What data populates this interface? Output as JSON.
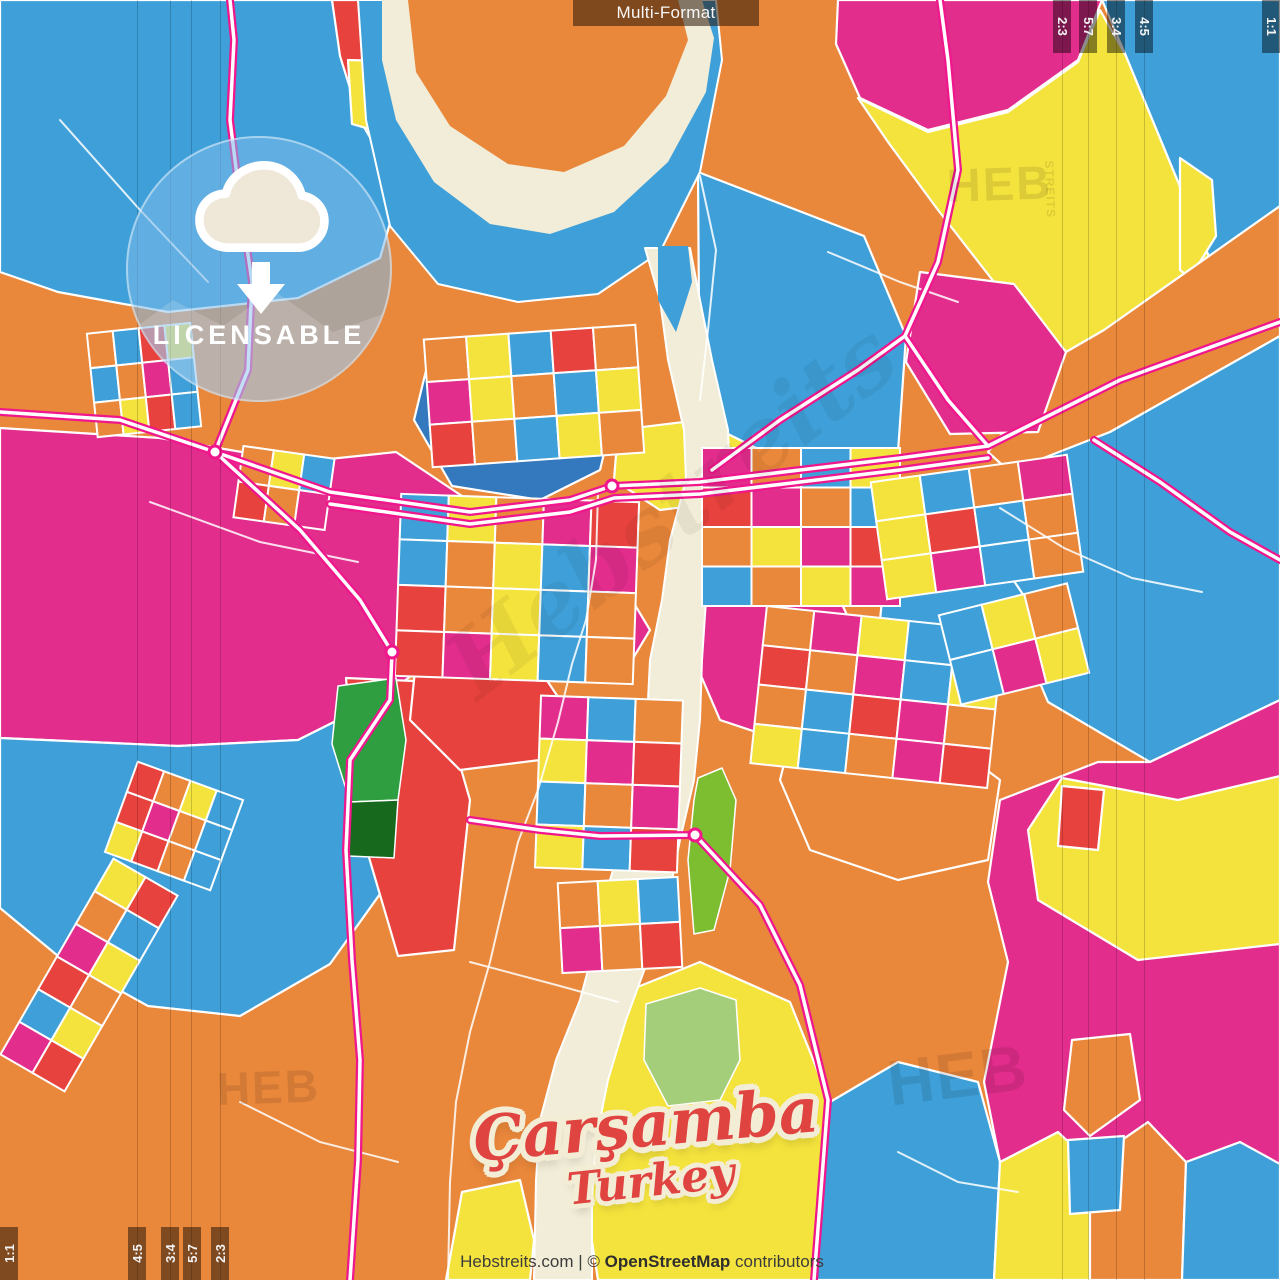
{
  "overlay": {
    "format_label": "Multi-Format",
    "badge": {
      "label": "LICENSABLE"
    },
    "title": {
      "city": "Çarşamba",
      "country": "Turkey"
    },
    "attribution": {
      "site": "Hebstreits.com",
      "separator": " | ",
      "copyright": "© ",
      "osm": "OpenStreetMap",
      "contributors": " contributors"
    },
    "markers": {
      "strip_width": 18,
      "strip_length": 53,
      "top_right": [
        {
          "label": "2:3",
          "x": 1053
        },
        {
          "label": "5:7",
          "x": 1079
        },
        {
          "label": "3:4",
          "x": 1107
        },
        {
          "label": "4:5",
          "x": 1135
        },
        {
          "label": "1:1",
          "x": 1262
        }
      ],
      "bottom_left": [
        {
          "label": "1:1",
          "x": 0
        },
        {
          "label": "4:5",
          "x": 128
        },
        {
          "label": "3:4",
          "x": 161
        },
        {
          "label": "5:7",
          "x": 183
        },
        {
          "label": "2:3",
          "x": 211
        }
      ]
    },
    "guides_x": [
      137,
      170,
      191,
      220,
      1062,
      1088,
      1116,
      1144
    ],
    "watermarks": [
      {
        "text": "HEB",
        "x": 946,
        "y": 162,
        "size": 47,
        "rot": -2,
        "small": "STREITS",
        "script": false
      },
      {
        "text": "HEB",
        "x": 884,
        "y": 1052,
        "size": 64,
        "rot": -7,
        "small": "",
        "script": false
      },
      {
        "text": "HEB",
        "x": 216,
        "y": 1066,
        "size": 46,
        "rot": -2,
        "small": "",
        "script": false
      },
      {
        "text": "Hebstreits",
        "x": 430,
        "y": 640,
        "size": 92,
        "rot": -38,
        "small": "",
        "script": true
      }
    ]
  },
  "palette": {
    "O": "#E9873B",
    "Y": "#F5E33D",
    "M": "#E22D8D",
    "B": "#3FA0D9",
    "D": "#3478BE",
    "R": "#E7423D",
    "C": "#F2EDD8",
    "G1": "#7CBE2F",
    "G2": "#2E9E41",
    "G3": "#17691D",
    "G4": "#A5CE7A",
    "road_casing": "#F0168C",
    "road_fill": "#FFFFFF"
  },
  "map": {
    "base": "O",
    "regions": [
      {
        "c": "B",
        "p": "0,0 332,0 342,58 368,128 400,188 380,258 298,298 168,312 58,292 0,272"
      },
      {
        "c": "R",
        "p": "332,0 478,0 452,58 428,138 398,186 360,120 340,56"
      },
      {
        "c": "Y",
        "p": "348,60 420,62 394,136 352,124"
      },
      {
        "c": "M",
        "p": "838,0 1102,0 1078,60 1008,110 928,130 860,98 836,44"
      },
      {
        "c": "Y",
        "p": "858,98 928,132 1008,112 1078,62 1100,10 1126,56 1222,288 1198,378 1094,376 1008,300 938,210 888,142"
      },
      {
        "c": "B",
        "p": "1102,0 1280,0 1280,206 1236,238 1222,288 1126,56"
      },
      {
        "c": "Y",
        "p": "1180,158 1212,180 1216,236 1190,278 1180,270"
      },
      {
        "c": "O",
        "p": "988,452 1066,352 1104,330 1280,206 1280,336 1110,432 1010,472"
      },
      {
        "c": "B",
        "p": "1008,472 1110,432 1280,336 1280,700 1150,762 1048,702 988,560 954,502"
      },
      {
        "c": "M",
        "p": "920,272 1014,284 1066,352 1038,432 950,434 906,362"
      },
      {
        "c": "B",
        "p": "698,172 864,236 906,336 898,452 700,456"
      },
      {
        "c": "M",
        "p": "0,428 160,438 300,462 396,452 468,500 518,560 480,626 378,700 298,740 178,746 0,738"
      },
      {
        "c": "B",
        "p": "0,738 178,746 298,740 378,700 424,736 434,800 390,880 330,964 240,1016 148,1006 58,956 0,908"
      },
      {
        "c": "D",
        "p": "432,346 560,352 612,420 600,470 540,500 452,486 414,420"
      },
      {
        "c": "R",
        "p": "346,678 436,682 470,800 454,950 398,956 358,820"
      },
      {
        "c": "Y",
        "p": "600,1002 700,962 790,1002 830,1102 814,1280 598,1280 578,1152 560,1102 590,1042"
      },
      {
        "c": "B",
        "p": "814,1280 830,1102 898,1062 978,1082 1000,1162 994,1280"
      },
      {
        "c": "Y",
        "p": "994,1280 1000,1162 1058,1132 1090,1162 1090,1280"
      },
      {
        "c": "O",
        "p": "1090,1280 1090,1162 1148,1122 1186,1162 1182,1280"
      },
      {
        "c": "B",
        "p": "1182,1280 1186,1162 1240,1142 1280,1162 1280,1280"
      },
      {
        "c": "M",
        "p": "1000,800 1098,762 1150,762 1280,700 1280,1164 1240,1142 1186,1162 1148,1122 1090,1162 1058,1132 1000,1162 984,1082 1008,962 988,882"
      },
      {
        "c": "Y",
        "p": "1062,778 1178,800 1280,776 1280,944 1138,960 1038,900 1028,830"
      },
      {
        "c": "R",
        "p": "1062,786 1104,790 1098,850 1058,846"
      },
      {
        "c": "O",
        "p": "1072,1040 1130,1034 1140,1100 1090,1136 1064,1110"
      },
      {
        "c": "B",
        "p": "1068,1140 1124,1136 1120,1210 1070,1214"
      },
      {
        "c": "M",
        "p": "700,540 780,560 840,600 868,660 848,720 780,740 720,720 690,650"
      },
      {
        "c": "O",
        "p": "800,700 920,720 1000,780 988,860 898,880 810,850 780,780"
      },
      {
        "c": "B",
        "p": "888,540 1000,560 1040,620 1008,680 928,690 878,640"
      },
      {
        "c": "Y",
        "p": "618,430 700,420 760,450 740,500 660,510 614,480"
      },
      {
        "c": "R",
        "p": "420,620 520,640 560,700 540,760 460,770 410,720"
      },
      {
        "c": "M",
        "p": "540,560 620,580 650,630 620,680 560,680 520,630"
      },
      {
        "c": "Y",
        "p": "446,1280 462,1192 520,1180 534,1240 530,1280"
      }
    ],
    "river": {
      "lake": "358,0 716,0 722,60 700,172 660,252 598,294 518,302 438,284 390,226 366,120",
      "corridor": "645,248 660,300 668,360 684,430 686,480 670,540 662,600 650,660 648,700 640,760 628,820 610,880 596,940 580,1000 556,1060 540,1120 536,1180 534,1280 592,1280 592,1200 596,1140 608,1080 626,1020 648,960 668,900 680,840 694,780 700,720 702,660 706,600 710,540 730,480 728,430 712,360 700,300 690,248",
      "channel": "658,246 688,246 692,282 676,332 658,300",
      "shore": "382,0 702,0 714,38 706,92 668,162 614,212 550,234 490,224 434,182 396,120 382,60",
      "island": "408,0 678,0 688,40 666,96 624,146 564,172 508,164 450,126 416,72"
    },
    "greens": [
      {
        "c": "G2",
        "p": "338,686 396,678 406,740 398,800 350,802 332,744"
      },
      {
        "c": "G3",
        "p": "350,802 398,800 394,858 348,856"
      },
      {
        "c": "G1",
        "p": "698,778 722,768 736,800 730,870 714,930 694,934 688,860 694,800"
      },
      {
        "c": "G4",
        "p": "646,1004 700,988 736,1000 740,1060 720,1100 668,1106 644,1060"
      }
    ],
    "clusters": [
      {
        "x": 92,
        "y": 328,
        "w": 104,
        "h": 104,
        "rot": -6,
        "rows": 3,
        "cols": 4,
        "seq": "OBRYBOMBOYRB"
      },
      {
        "x": 238,
        "y": 452,
        "w": 92,
        "h": 72,
        "rot": 8,
        "rows": 2,
        "cols": 3,
        "seq": "OYBROM"
      },
      {
        "x": 428,
        "y": 332,
        "w": 212,
        "h": 128,
        "rot": -4,
        "rows": 3,
        "cols": 5,
        "seq": "OYBROMYOBYROBYO"
      },
      {
        "x": 398,
        "y": 498,
        "w": 238,
        "h": 182,
        "rot": 2,
        "rows": 4,
        "cols": 5,
        "seq": "BYOMRBOYBMROYBORMYBO"
      },
      {
        "x": 702,
        "y": 448,
        "w": 198,
        "h": 158,
        "rot": 0,
        "rows": 4,
        "cols": 4,
        "seq": "MOBYRMOBOYMRBOYM"
      },
      {
        "x": 758,
        "y": 618,
        "w": 238,
        "h": 158,
        "rot": 6,
        "rows": 4,
        "cols": 5,
        "seq": "OMYBOROMBYOBRMOYBOMR"
      },
      {
        "x": 878,
        "y": 468,
        "w": 198,
        "h": 118,
        "rot": -8,
        "rows": 3,
        "cols": 4,
        "seq": "YBOMYRBOYMBO"
      },
      {
        "x": 538,
        "y": 698,
        "w": 142,
        "h": 172,
        "rot": 2,
        "rows": 4,
        "cols": 3,
        "seq": "MBOYMRBOMYBR"
      },
      {
        "x": 948,
        "y": 598,
        "w": 132,
        "h": 92,
        "rot": -14,
        "rows": 2,
        "cols": 3,
        "seq": "BYOBMY"
      },
      {
        "x": 118,
        "y": 778,
        "w": 112,
        "h": 96,
        "rot": 20,
        "rows": 3,
        "cols": 4,
        "seq": "ROYBRMOBYROB"
      },
      {
        "x": 52,
        "y": 862,
        "w": 74,
        "h": 226,
        "rot": 30,
        "rows": 6,
        "cols": 2,
        "seq": "YROBMYROBYMR"
      },
      {
        "x": 560,
        "y": 880,
        "w": 120,
        "h": 90,
        "rot": -3,
        "rows": 2,
        "cols": 3,
        "seq": "OYBMOR"
      }
    ],
    "roads": [
      {
        "p": "0,412 120,420 215,452 330,492 470,512 570,500 612,486 700,482 800,470 900,458 988,446 1120,380 1280,322",
        "cased": true
      },
      {
        "p": "330,504 470,524 570,512 614,498 700,494 800,482 900,470 988,458",
        "cased": true
      },
      {
        "p": "215,452 248,370 252,282 240,200 230,120 234,40 230,0",
        "cased": true
      },
      {
        "p": "215,452 300,530 360,600 392,652 390,700 350,760 346,850 352,960 360,1060 358,1160 350,1280",
        "cased": true
      },
      {
        "p": "695,835 760,905 800,985 828,1100 814,1280",
        "cased": true
      },
      {
        "p": "470,820 540,830 600,836 695,835",
        "cased": true
      },
      {
        "p": "712,470 780,420 858,370 905,336 938,262 958,170 948,60 940,0",
        "cased": true
      },
      {
        "p": "905,336 948,400 988,446",
        "cased": true
      },
      {
        "p": "1094,440 1160,482 1230,532 1280,560",
        "cased": true
      }
    ],
    "minor_roads": [
      "598,492 596,560 586,620 572,664 558,722 538,790 518,842 504,902 490,962 470,1032 456,1102 450,1182 448,1280",
      "60,120 140,210 208,282",
      "1000,508 1064,548 1132,578 1202,592",
      "828,252 900,282 958,302",
      "150,502 260,542 358,562",
      "470,962 560,986 618,1002",
      "898,1152 958,1182 1018,1192",
      "240,1102 320,1142 398,1162",
      "700,176 716,250 708,330 700,400"
    ],
    "roundabouts": [
      {
        "x": 215,
        "y": 452
      },
      {
        "x": 612,
        "y": 486
      },
      {
        "x": 695,
        "y": 835
      },
      {
        "x": 392,
        "y": 652
      }
    ]
  }
}
